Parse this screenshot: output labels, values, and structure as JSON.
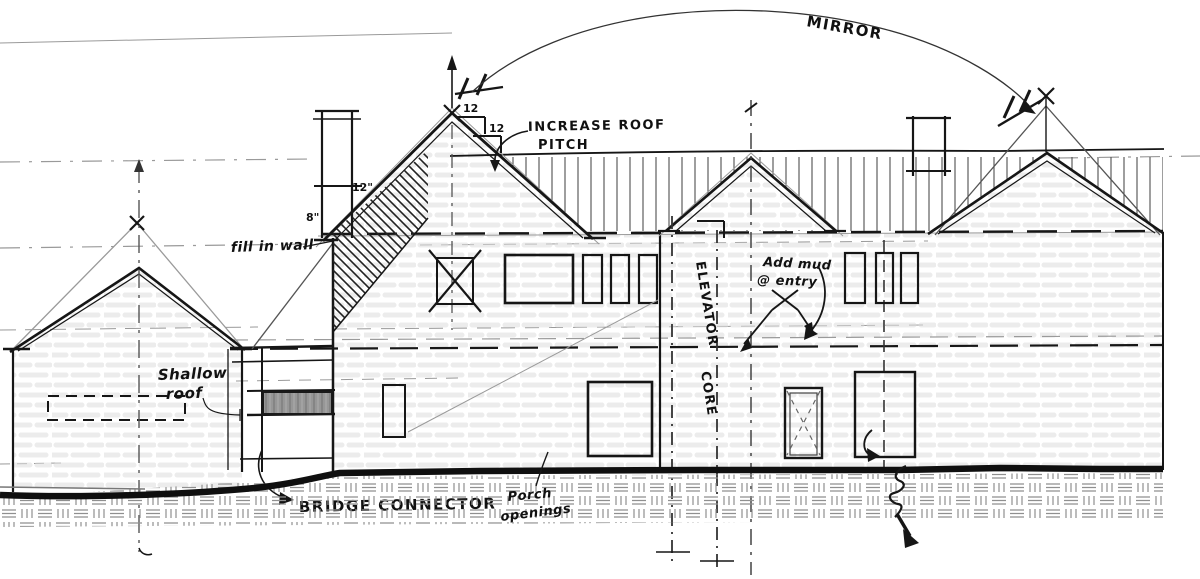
{
  "title": "Hand-drawn architectural elevation sketch with markup notes",
  "annotations": {
    "mirror": "MIRROR",
    "increase_roof": "INCREASE ROOF",
    "pitch_word": "PITCH",
    "pitch_rise": "12",
    "pitch_run": "12",
    "dim_twelve_in": "12\"",
    "dim_eight_in": "8\"",
    "fill_in_wall": "fill in wall",
    "shallow": "Shallow",
    "roof": "roof",
    "elevator": "ELEVATOR",
    "core": "CORE",
    "add_mud": "Add mud",
    "at_entry": "@ entry",
    "bridge_connector": "BRIDGE CONNECTOR",
    "porch": "Porch",
    "openings": "openings"
  },
  "colors": {
    "paper": "#ffffff",
    "ink": "#161616",
    "pencil": "#9a9a9a",
    "window_fill": "#979797",
    "stone_texture": "#dcdcdc"
  }
}
